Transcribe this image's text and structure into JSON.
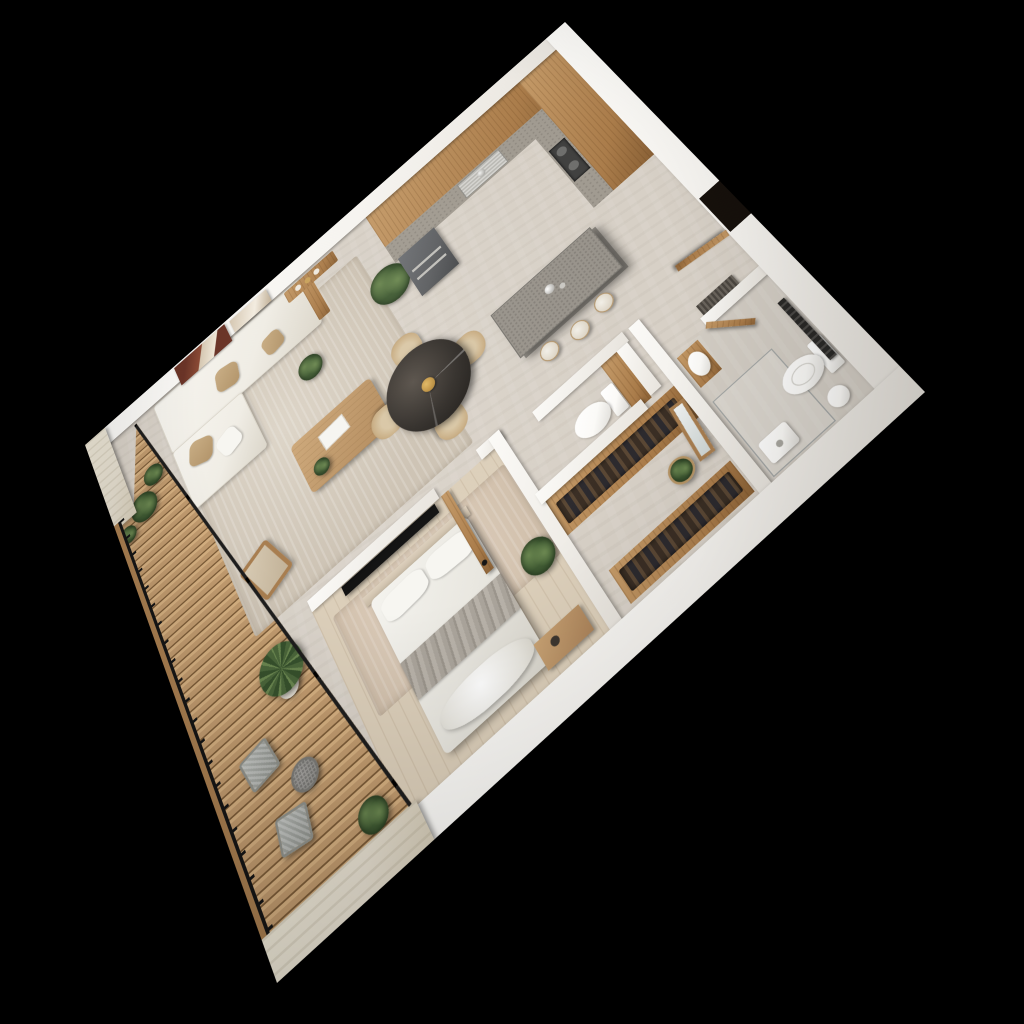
{
  "title": "isometric-3d-floor-plan-render",
  "palette": {
    "bg": "#000000",
    "wall": "#f6f4f0",
    "wall-dim": "#e8e4dd",
    "trav-wall": "#e6dfd0",
    "floor": "#d7d0c6",
    "bed-floor": "#dccfba",
    "bath-floor": "#d3cdc4",
    "deck": "#c09a6e",
    "deck-hi": "#d4af80",
    "deck-gap": "#7c5c38",
    "rail-wood": "#a87e50",
    "frame-black": "#151515",
    "wood": "#aa7c4a",
    "wood-hi": "#c49a68",
    "wood-deep": "#8a6136",
    "counter": "#a09a90",
    "island-top": "#97928a",
    "appliance": "#5b5d60",
    "steel": "#c0bfba",
    "marble": "#322e2a",
    "marble-hi": "#58514a",
    "gold": "#b98c3e",
    "cream": "#f0ede5",
    "cream-dim": "#dcd7cb",
    "tan": "#b2946a",
    "tan-hi": "#c9ae85",
    "rug": "#cdc3b4",
    "rug-hi": "#ddd5c8",
    "gray-throw": "#aaa49b",
    "tv": "#121212",
    "green": "#4a653a",
    "green-dark": "#36502c",
    "green-hi": "#69854f",
    "clothes-a": "#3a2e24",
    "clothes-b": "#5a4734",
    "clothes-c": "#2c2a2e",
    "gray-chair": "#b4b7b3",
    "gray-chair-dim": "#8e918c",
    "porcelain": "#fbfaf7",
    "porcelain-dim": "#d9d7d2",
    "maroon": "#6a3427",
    "art-beige": "#d5c7b2"
  },
  "scene": {
    "background": "black",
    "view": "top-down 3d apartment render, rotated with perspective",
    "rooms": [
      {
        "name": "kitchen",
        "items": [
          "l-shaped-wood-cabinets",
          "concrete-countertop",
          "stainless-sink",
          "cooktop",
          "oven-front",
          "kitchen-island",
          "bar-stools",
          "metal-decanters"
        ]
      },
      {
        "name": "dining-area",
        "items": [
          "round-marble-table",
          "gold-bowl",
          "four-beige-chairs"
        ]
      },
      {
        "name": "living-room",
        "items": [
          "white-sofa-with-chaise",
          "tan-pillows",
          "wall-art-maroon",
          "wall-art-beige",
          "console-table",
          "coffee-table",
          "book",
          "lounge-chair",
          "area-rug",
          "fiddle-plant",
          "small-plant"
        ]
      },
      {
        "name": "bedroom",
        "items": [
          "double-bed",
          "pillows",
          "gray-throw",
          "headboard",
          "wall-tv",
          "bed-rug",
          "foot-bench",
          "potted-plant",
          "wood-door"
        ]
      },
      {
        "name": "walk-in-closet",
        "items": [
          "wardrobe-hanging-clothes-nw",
          "wardrobe-hanging-clothes-se",
          "leaning-mirror",
          "basket-plant"
        ]
      },
      {
        "name": "wc-nook",
        "items": [
          "toilet",
          "wood-panel"
        ]
      },
      {
        "name": "bathroom",
        "items": [
          "toilet",
          "glass-shower",
          "shower-tray",
          "wood-vanity-basin",
          "towel-radiator",
          "round-stool"
        ]
      },
      {
        "name": "hallway",
        "items": [
          "entry-door-open",
          "entry-doorway",
          "floor-grille"
        ]
      },
      {
        "name": "deck",
        "items": [
          "wood-plank-decking",
          "black-metal-railing",
          "wood-handrail",
          "glass-wall-black-frame",
          "two-gray-deck-chairs",
          "round-side-table",
          "potted-palm",
          "bushes",
          "travertine-end-walls"
        ]
      }
    ]
  }
}
